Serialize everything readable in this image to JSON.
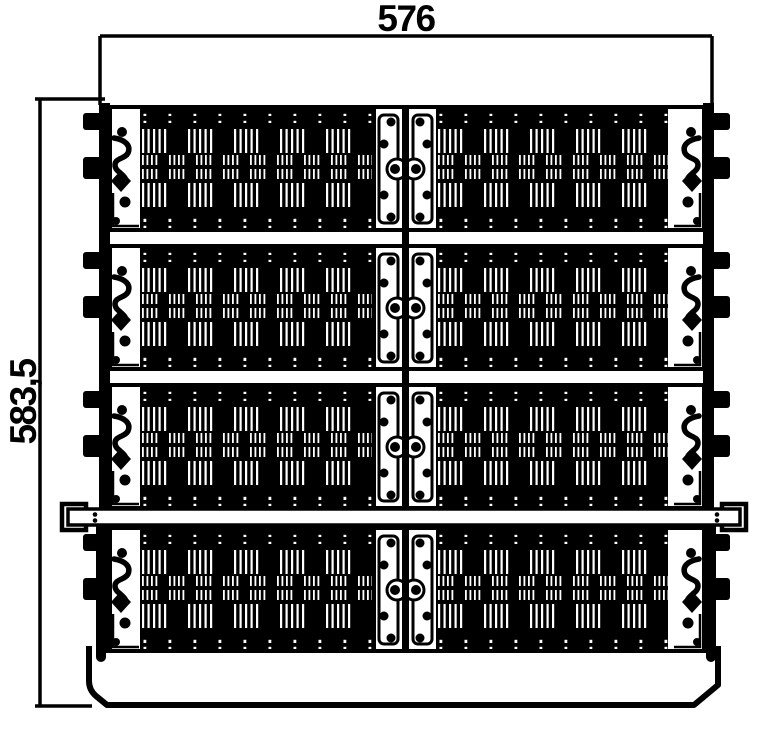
{
  "drawing": {
    "view": "front",
    "dimension_width_label": "576",
    "dimension_height_label": "583,5",
    "module_rows": 4,
    "modules_per_row": 2,
    "colors": {
      "line": "#000000",
      "background": "#ffffff"
    }
  }
}
